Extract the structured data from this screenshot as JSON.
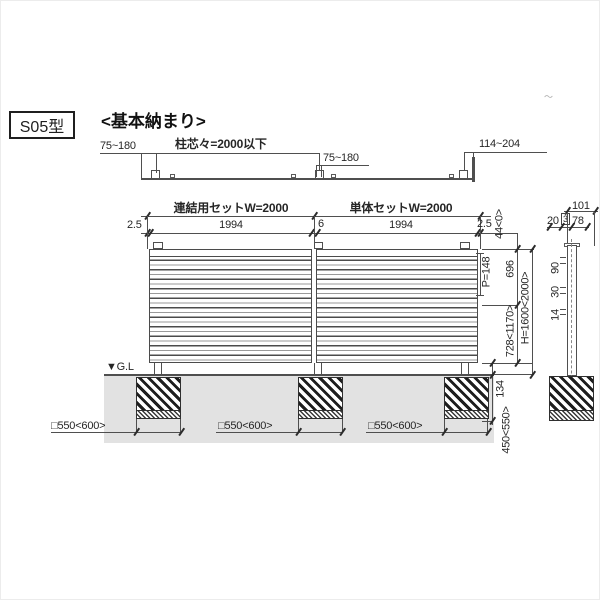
{
  "header": {
    "model": "S05型",
    "title": "<基本納まり>",
    "stray_mark": "〜"
  },
  "plan": {
    "offset_left": "75~180",
    "pitch": "柱芯々=2000以下",
    "offset_mid": "75~180",
    "offset_right": "114~204"
  },
  "elevation": {
    "set_left": "連結用セットW=2000",
    "set_right": "単体セットW=2000",
    "margin_left": "2.5",
    "panel_left": "1994",
    "joint": "6",
    "panel_right": "1994",
    "margin_right": "2.5",
    "gl": "▼G.L",
    "foundation_width": "□550<600>"
  },
  "vdims": {
    "cap": "44<0>",
    "pitch": "P=148",
    "upper": "696",
    "lower": "728<1170>",
    "height": "H=1600<2000>",
    "gl_to_panel": "134",
    "embed": "450<550>"
  },
  "section": {
    "total_width": "101",
    "w_back": "20",
    "w_gap": "3",
    "w_front": "78",
    "s1": "90",
    "s2": "30",
    "s3": "14"
  }
}
